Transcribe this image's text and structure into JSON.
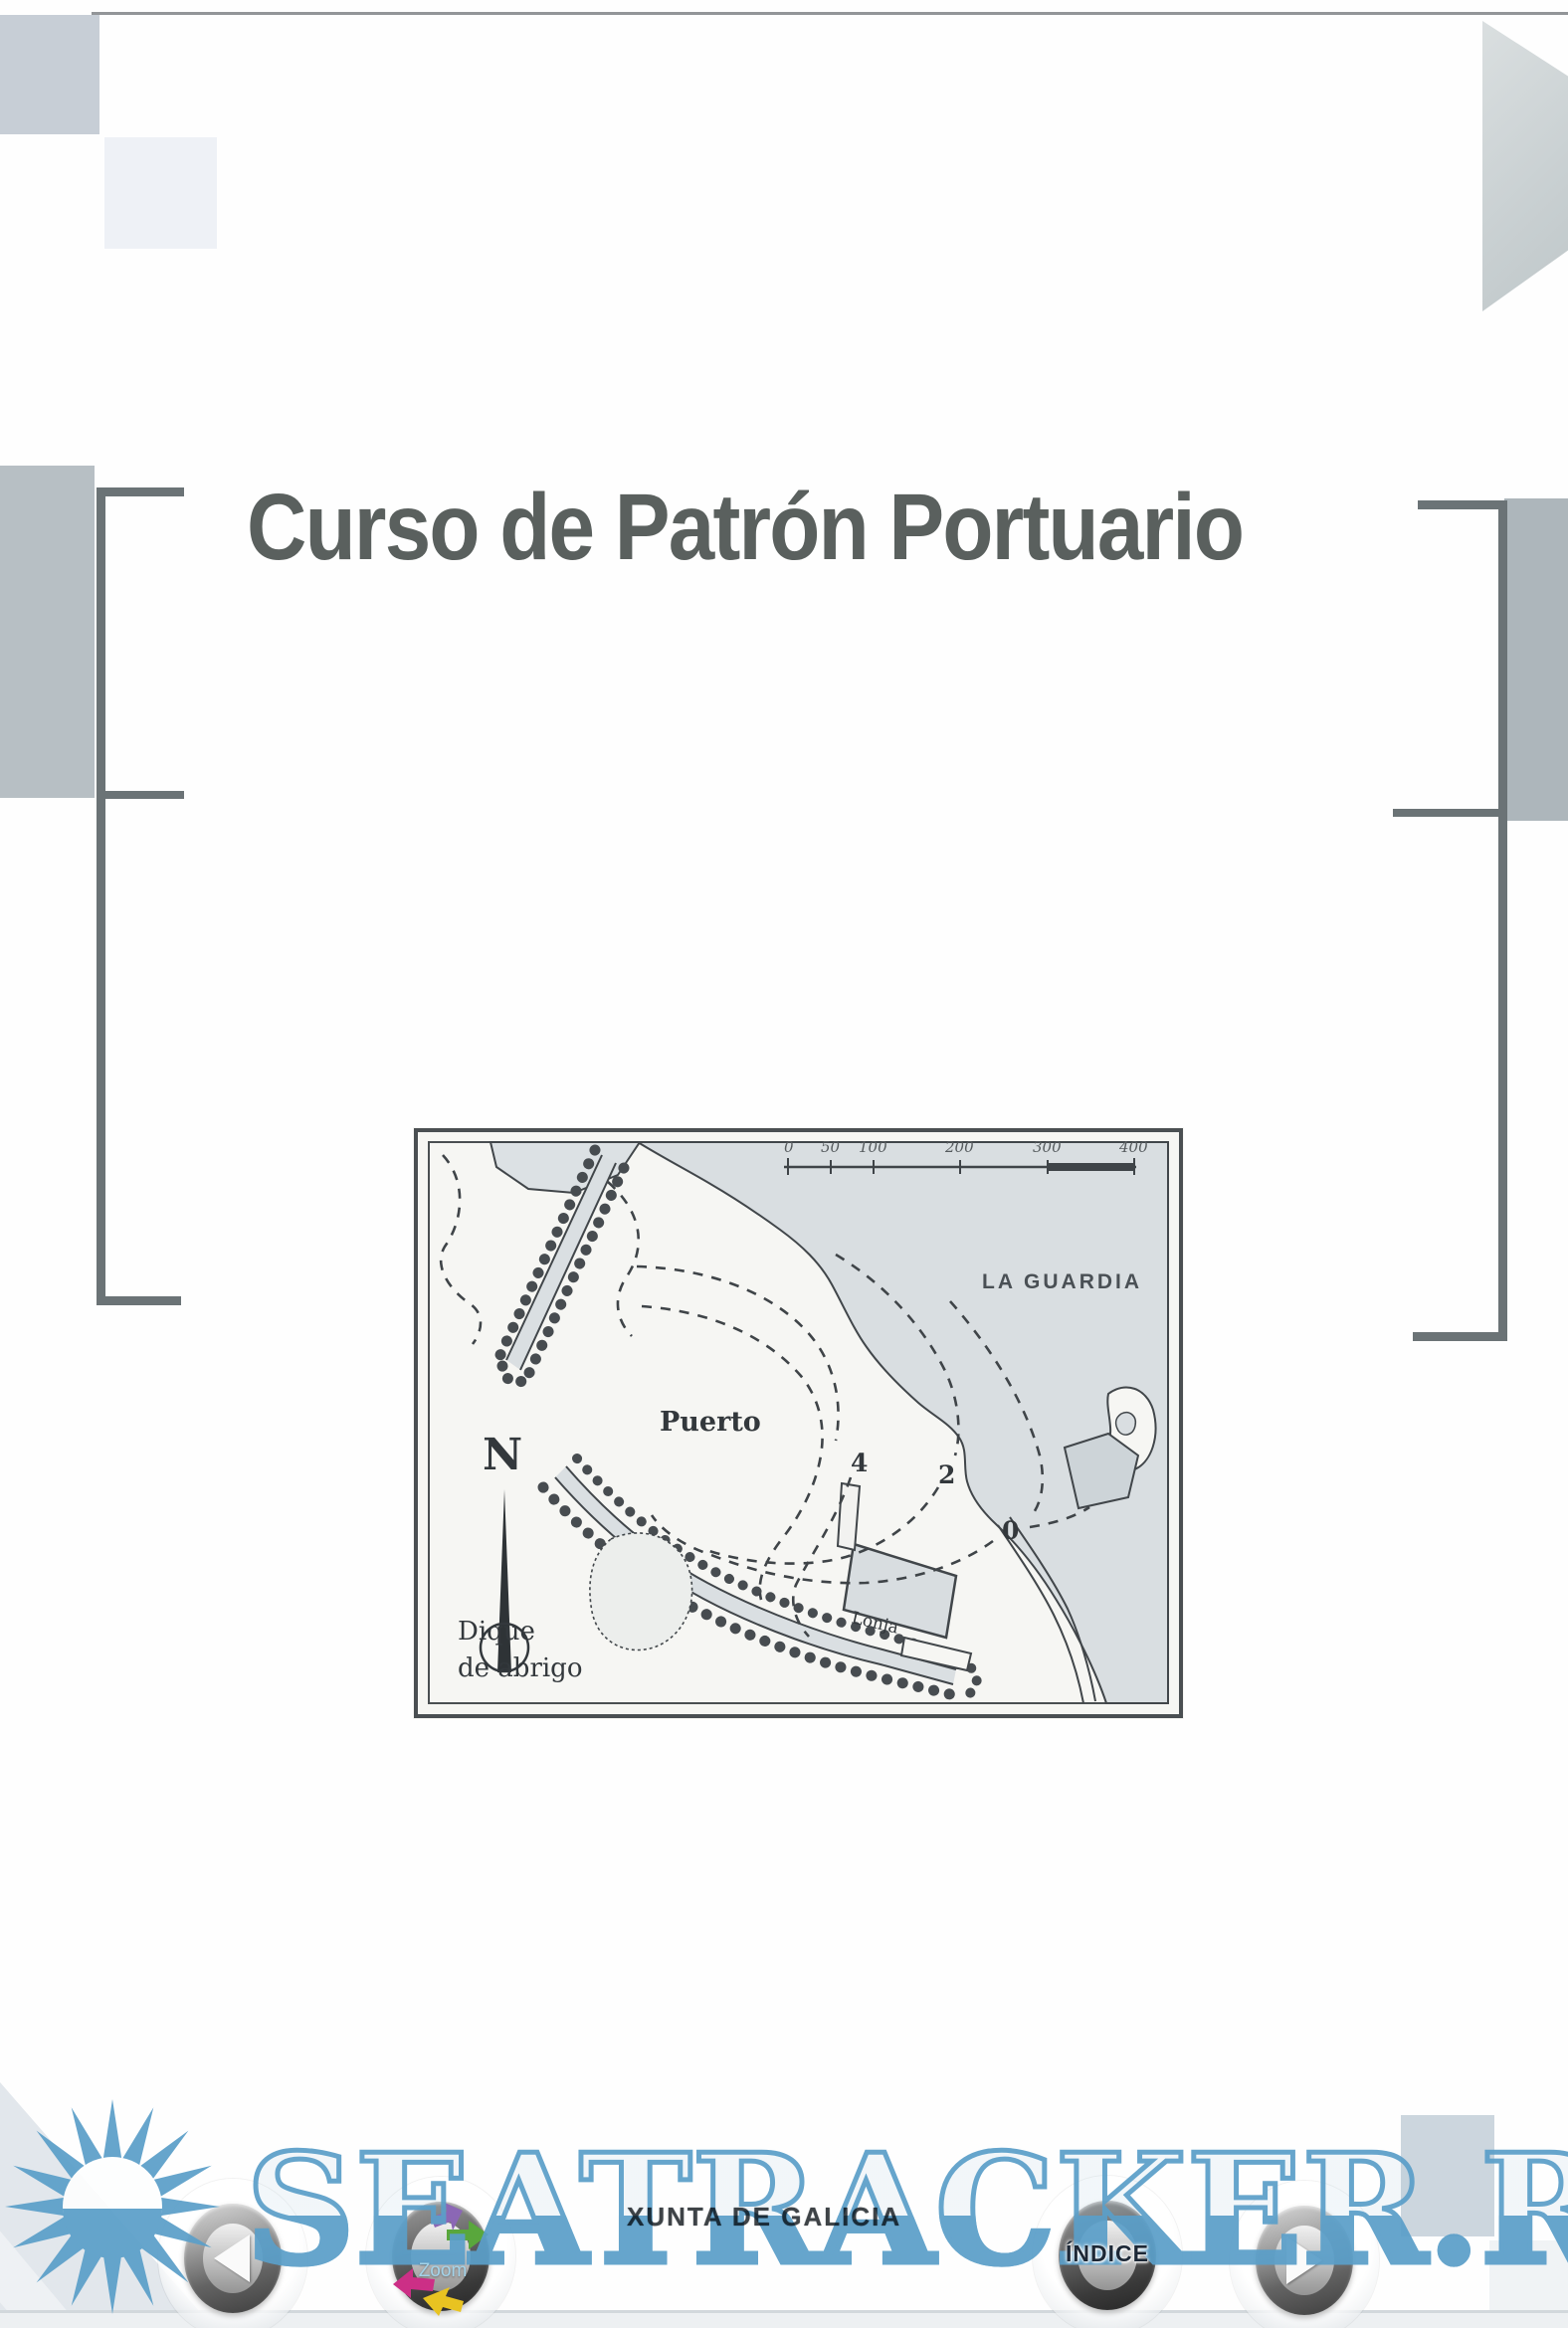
{
  "page": {
    "title": "Curso de Patrón Portuario",
    "publisher": "XUNTA DE GALICIA"
  },
  "map": {
    "labels": {
      "region": "LA GUARDIA",
      "harbor": "Puerto",
      "compass_north": "N",
      "breakwater_line1": "Dique",
      "breakwater_line2": "de abrigo",
      "building": "Lonja"
    },
    "depth_labels": [
      "4",
      "2",
      "0"
    ],
    "scale_bar": {
      "ticks": [
        "0",
        "50",
        "100",
        "200",
        "300",
        "400"
      ]
    }
  },
  "watermark": {
    "text": "SEATRACKER.RU",
    "color": "#5b9fc9"
  },
  "toolbar": {
    "prev_label": "previous page",
    "next_label": "next page",
    "zoom_label": "Zoom",
    "indice_label": "ÍNDICE"
  }
}
